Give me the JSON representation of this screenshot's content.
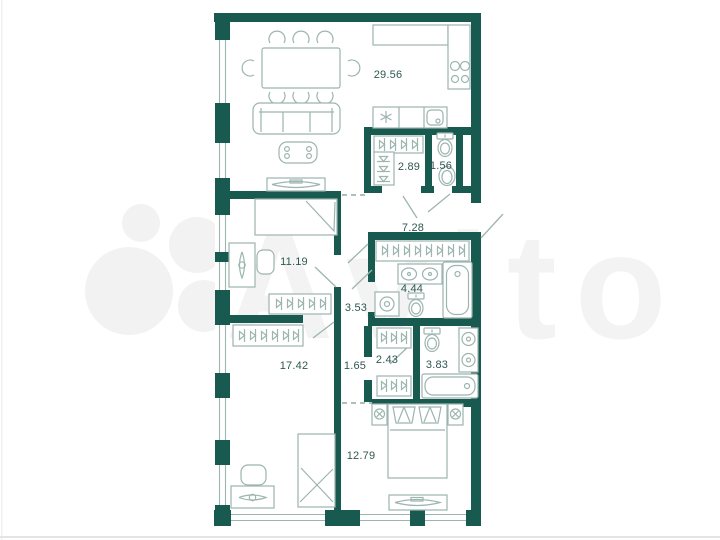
{
  "watermark": {
    "brand": "Avito"
  },
  "plan": {
    "type": "apartment-floor-plan",
    "units": "m2",
    "colors": {
      "wall": "#185a4f",
      "furniture": "#9db5af",
      "label": "#2f5850",
      "watermark": "#f3f3f3"
    },
    "rooms": [
      {
        "id": "living-kitchen",
        "area": "29.56"
      },
      {
        "id": "wardrobe-hall",
        "area": "2.89"
      },
      {
        "id": "wc",
        "area": "1.56"
      },
      {
        "id": "hallway",
        "area": "7.28"
      },
      {
        "id": "bedroom-1",
        "area": "11.19"
      },
      {
        "id": "bathroom-1",
        "area": "4.44"
      },
      {
        "id": "corridor",
        "area": "3.53"
      },
      {
        "id": "wardrobe-2",
        "area": "2.43"
      },
      {
        "id": "bathroom-2",
        "area": "3.83"
      },
      {
        "id": "hall-2",
        "area": "1.65"
      },
      {
        "id": "bedroom-2",
        "area": "17.42"
      },
      {
        "id": "bedroom-3",
        "area": "12.79"
      }
    ]
  }
}
